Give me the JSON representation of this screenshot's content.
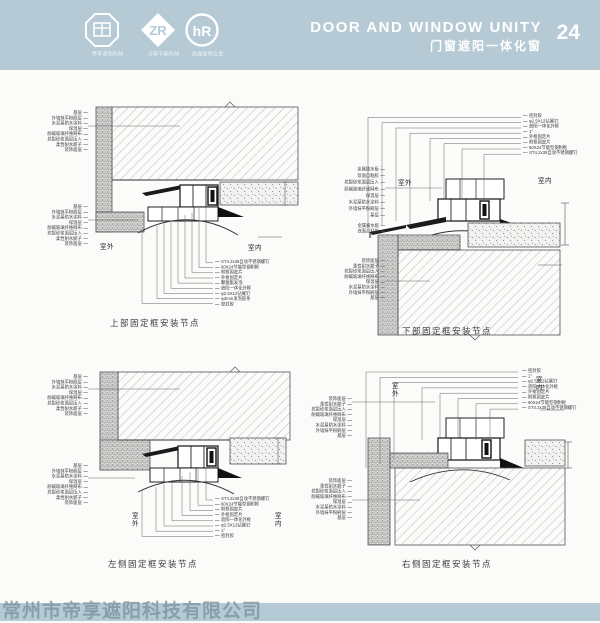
{
  "header": {
    "title_en": "DOOR AND WINDOW UNITY",
    "title_zh": "门窗遮阳一体化窗",
    "page_number": "24",
    "logos": [
      {
        "caption": "帝享遮阳科技"
      },
      {
        "caption": "日帮节能科技"
      },
      {
        "caption": "高端窗饰五金"
      }
    ]
  },
  "shared": {
    "outdoor": "室外",
    "indoor": "室内"
  },
  "panels": [
    {
      "caption": "上部固定框安装节点",
      "layer_stack_a": [
        "基层",
        "外墙抹平粉刷层",
        "水泥基防水涂料",
        "保温层",
        "耐碱玻璃纤维网布",
        "抗裂砂浆面层压入",
        "柔性耐水腻子",
        "装饰面层"
      ],
      "layer_stack_b": [
        "基层",
        "外墙抹平粉刷层",
        "水泥基防水涂料",
        "保温层",
        "耐碱玻璃纤维网布",
        "抗裂砂浆面层压入",
        "柔性耐水腻子",
        "装饰面层"
      ],
      "frame_stack": [
        "ST4.2x38自攻不锈钢螺钉",
        "60X24节能型钢附框",
        "附框固定片",
        "外框固定片",
        "聚氨酯发泡",
        "遮阳一体化外框",
        "φ2.5X12钻尾钉",
        "φ3mm发泡胶条",
        "密封胶"
      ]
    },
    {
      "caption": "下部固定框安装节点",
      "layer_stack_a": [
        "金属披水板",
        "双面自粘胶",
        "抗裂砂浆面层压入",
        "耐碱玻璃纤维网布",
        "保温层",
        "水泥基防水涂料",
        "外墙抹平粉刷层",
        "基层"
      ],
      "flashing_stack": [
        "金属披水板",
        "双面自粘胶"
      ],
      "layer_stack_b": [
        "装饰面层",
        "柔性耐水腻子",
        "抗裂砂浆面层压入",
        "耐碱玻璃纤维网布",
        "保温层",
        "水泥基防水涂料",
        "外墙抹平粉刷层",
        "基层"
      ],
      "frame_stack": [
        "密封胶",
        "φ2.5X12钻尾钉",
        "遮阳一体化外框",
        "1°",
        "外框固定片",
        "附框固定片",
        "60X24节能型钢附框",
        "ST4.2x38自攻不锈钢螺钉"
      ]
    },
    {
      "caption": "左侧固定框安装节点",
      "layer_stack_a": [
        "基层",
        "外墙抹平粉刷层",
        "水泥基防水涂料",
        "保温层",
        "耐碱玻璃纤维网布",
        "抗裂砂浆面层压入",
        "柔性耐水腻子",
        "装饰面层"
      ],
      "layer_stack_b": [
        "基层",
        "外墙抹平粉刷层",
        "水泥基防水涂料",
        "保温层",
        "耐碱玻璃纤维网布",
        "抗裂砂浆面层压入",
        "柔性耐水腻子",
        "装饰面层"
      ],
      "frame_stack": [
        "ST4.2x38自攻不锈钢螺钉",
        "60X24节能型钢附框",
        "附框固定片",
        "外框固定片",
        "遮阳一体化外框",
        "φ2.5X12钻尾钉",
        "1°",
        "密封胶"
      ]
    },
    {
      "caption": "右侧固定框安装节点",
      "layer_stack_a": [
        "装饰面层",
        "柔性耐水腻子",
        "抗裂砂浆面层压入",
        "耐碱玻璃纤维网布",
        "保温层",
        "水泥基防水涂料",
        "外墙抹平粉刷层",
        "基层"
      ],
      "layer_stack_b": [
        "装饰面层",
        "柔性耐水腻子",
        "抗裂砂浆面层压入",
        "耐碱玻璃纤维网布",
        "保温层",
        "水泥基防水涂料",
        "外墙抹平粉刷层",
        "基层"
      ],
      "frame_stack": [
        "密封胶",
        "1°",
        "φ2.5X12钻尾钉",
        "遮阳一体化外框",
        "外框固定片",
        "附框固定片",
        "60X24节能型钢附框",
        "ST4.2x38自攻不锈钢螺钉"
      ]
    }
  ],
  "footer": {
    "watermark": "常州市帝享遮阳科技有限公司"
  },
  "colors": {
    "band": "#b5cad4",
    "line": "#3a3a3a",
    "watermark": "#7c949f"
  }
}
